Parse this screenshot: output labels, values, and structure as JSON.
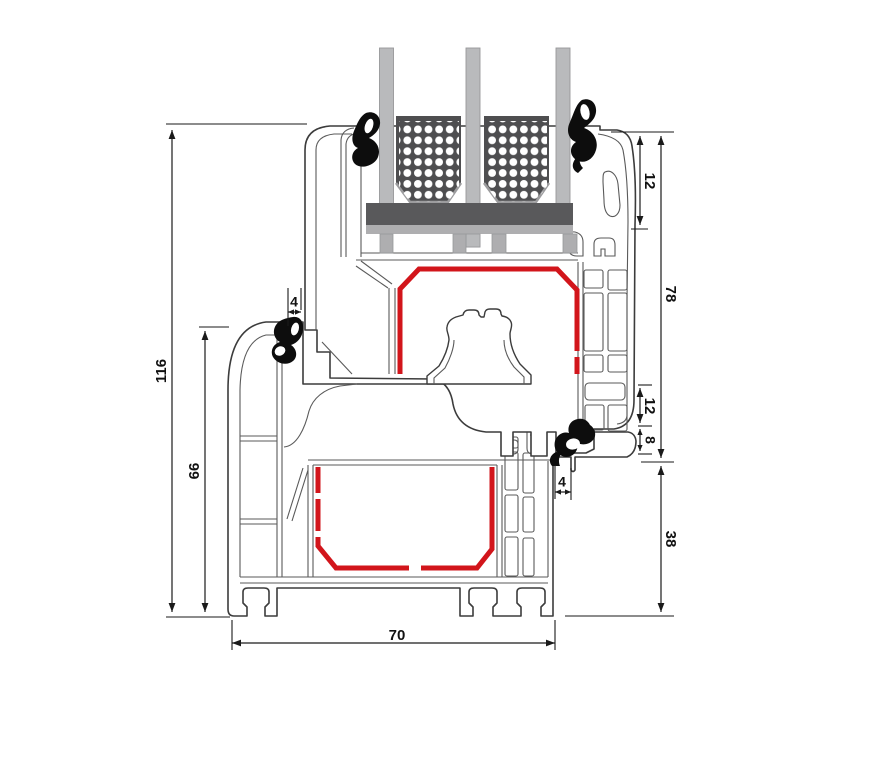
{
  "diagram": {
    "type": "technical-cross-section",
    "subject": "window-frame-and-sash-profile-section"
  },
  "colors": {
    "background": "#ffffff",
    "outline": "#3c3c3c",
    "inner_line": "#5a5a5a",
    "dim_line": "#1a1a1a",
    "red_gasket": "#d2151b",
    "black_gasket": "#0d0d0d",
    "glass": "#b9babc",
    "glass_stroke": "#97989a",
    "spacer": "#4e4e50",
    "spacer_bevel": "#9c9c9e",
    "bar_dark": "#59595b",
    "bar_light": "#aeaeb0",
    "dot": "#ffffff"
  },
  "dimensions": [
    {
      "id": "h116",
      "value": "116",
      "orient": "v",
      "x": 172,
      "y1": 130,
      "y2": 612,
      "label": {
        "x": 162,
        "y": 371,
        "rot": -90
      },
      "ticks": [
        [
          166,
          124,
          307,
          124
        ],
        [
          166,
          617,
          230,
          617
        ]
      ],
      "small": false
    },
    {
      "id": "h66",
      "value": "66",
      "orient": "v",
      "x": 205,
      "y1": 331,
      "y2": 612,
      "label": {
        "x": 195,
        "y": 471,
        "rot": -90
      },
      "ticks": [
        [
          199,
          327,
          229,
          327
        ]
      ],
      "small": false
    },
    {
      "id": "w4a",
      "value": "4",
      "orient": "h",
      "y": 312,
      "x1": 288,
      "x2": 301,
      "label": {
        "x": 294,
        "y": 303,
        "rot": 0
      },
      "ticks": [
        [
          288,
          288,
          288,
          326
        ],
        [
          301,
          288,
          301,
          310
        ]
      ],
      "small": true
    },
    {
      "id": "h12a",
      "value": "12",
      "orient": "v",
      "x": 640,
      "y1": 136,
      "y2": 225,
      "label": {
        "x": 649,
        "y": 181,
        "rot": 90
      },
      "ticks": [
        [
          611,
          132,
          674,
          132
        ],
        [
          631,
          229,
          648,
          229
        ]
      ],
      "small": false
    },
    {
      "id": "h78",
      "value": "78",
      "orient": "v",
      "x": 661,
      "y1": 136,
      "y2": 458,
      "label": {
        "x": 670,
        "y": 294,
        "rot": 90
      },
      "ticks": [
        [
          641,
          462,
          674,
          462
        ]
      ],
      "small": false
    },
    {
      "id": "h12b",
      "value": "12",
      "orient": "v",
      "x": 640,
      "y1": 388,
      "y2": 423,
      "label": {
        "x": 649,
        "y": 406,
        "rot": 90
      },
      "ticks": [
        [
          638,
          385,
          652,
          385
        ],
        [
          638,
          426,
          652,
          426
        ]
      ],
      "small": false
    },
    {
      "id": "h8",
      "value": "8",
      "orient": "v",
      "x": 640,
      "y1": 429,
      "y2": 451,
      "label": {
        "x": 649,
        "y": 440,
        "rot": 90
      },
      "ticks": [
        [
          638,
          454,
          652,
          454
        ]
      ],
      "small": true
    },
    {
      "id": "w4b",
      "value": "4",
      "orient": "h",
      "y": 492,
      "x1": 555,
      "x2": 571,
      "label": {
        "x": 562,
        "y": 483,
        "rot": 0
      },
      "ticks": [
        [
          555,
          465,
          555,
          499
        ],
        [
          571,
          468,
          571,
          500
        ]
      ],
      "small": true
    },
    {
      "id": "h38",
      "value": "38",
      "orient": "v",
      "x": 661,
      "y1": 466,
      "y2": 612,
      "label": {
        "x": 670,
        "y": 539,
        "rot": 90
      },
      "ticks": [
        [
          565,
          616,
          674,
          616
        ]
      ],
      "small": false
    },
    {
      "id": "w70",
      "value": "70",
      "orient": "h",
      "y": 643,
      "x1": 232,
      "x2": 555,
      "label": {
        "x": 397,
        "y": 636,
        "rot": 0
      },
      "ticks": [
        [
          232,
          620,
          232,
          650
        ],
        [
          555,
          620,
          555,
          650
        ]
      ],
      "small": false
    }
  ]
}
